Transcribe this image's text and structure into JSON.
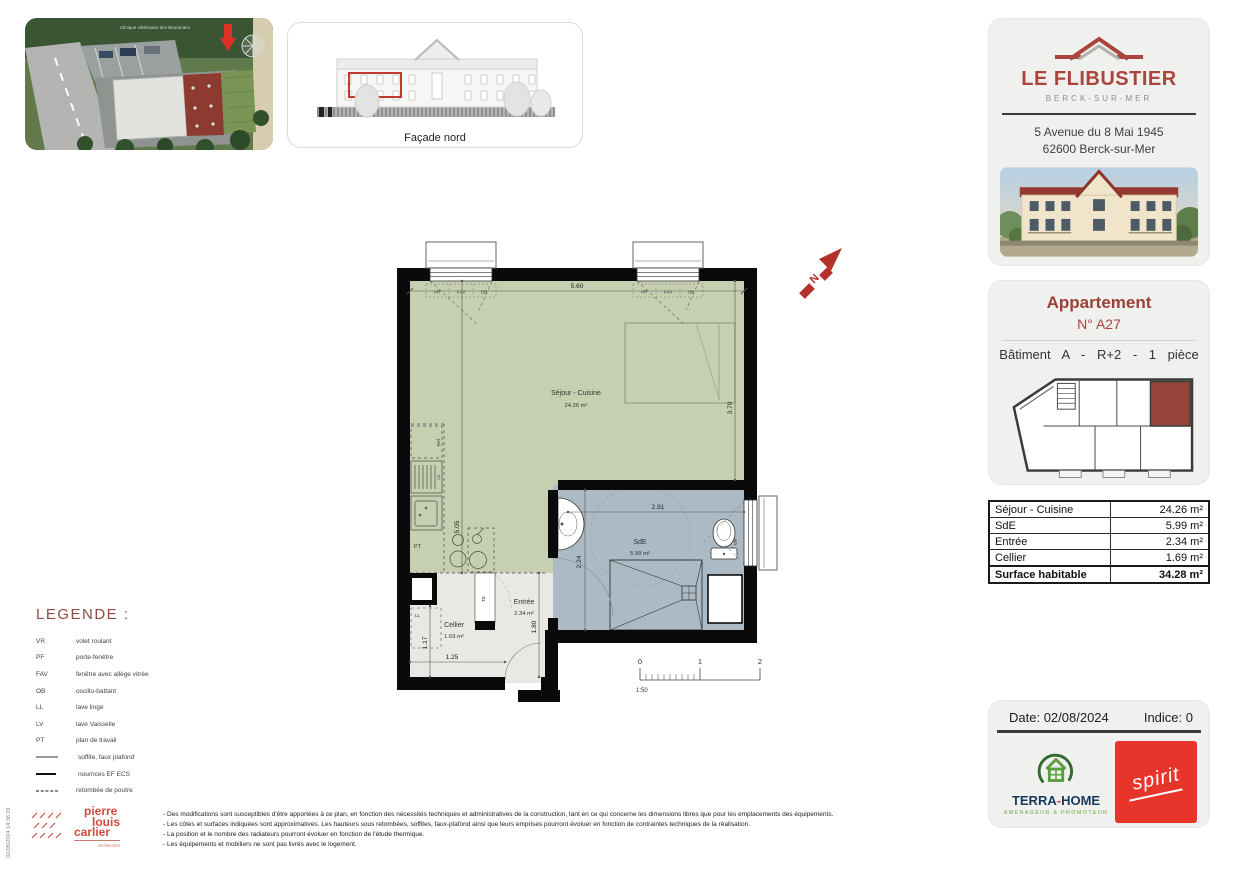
{
  "site_thumb": {
    "caption": "Clinique vétérinaire des Beuraniers"
  },
  "facade_thumb": {
    "caption": "Façade nord"
  },
  "project": {
    "name": "LE FLIBUSTIER",
    "city": "BERCK-SUR-MER",
    "address_line1": "5 Avenue du 8 Mai 1945",
    "address_line2": "62600 Berck-sur-Mer"
  },
  "apartment": {
    "title": "Appartement",
    "number": "N° A27",
    "summary": "Bâtiment A - R+2 - 1 pièce"
  },
  "areas": {
    "rows": [
      {
        "label": "Séjour - Cuisine",
        "value": "24.26 m²"
      },
      {
        "label": "SdE",
        "value": "5.99 m²"
      },
      {
        "label": "Entrée",
        "value": "2.34 m²"
      },
      {
        "label": "Cellier",
        "value": "1.69 m²"
      },
      {
        "label": "Surface habitable",
        "value": "34.28 m²",
        "bold": true
      }
    ]
  },
  "revision": {
    "date_label": "Date:",
    "date": "02/08/2024",
    "indice_label": "Indice:",
    "indice": "0"
  },
  "logos": {
    "terra_home": {
      "name_a": "TERRA",
      "sep": "-",
      "name_b": "HOME",
      "tagline": "AMÉNAGEUR & PROMOTEUR"
    },
    "spirit": {
      "name": "spirit"
    },
    "architect": {
      "line1": "pierre",
      "line2": "louis",
      "line3": "carlier",
      "sub": "architectes"
    }
  },
  "legend": {
    "title": "LEGENDE :",
    "items": [
      {
        "key": "VR",
        "desc": "volet roulant"
      },
      {
        "key": "PF",
        "desc": "porte-fenêtre"
      },
      {
        "key": "FAV",
        "desc": "fenêtre avec allège vitrée"
      },
      {
        "key": "OB",
        "desc": "oscillo-battant"
      },
      {
        "key": "LL",
        "desc": "lave linge"
      },
      {
        "key": "LV",
        "desc": "lave Vaisselle"
      },
      {
        "key": "PT",
        "desc": "plan de travail"
      },
      {
        "type": "hatch",
        "desc": "soffite, faux plafond"
      },
      {
        "type": "grid",
        "desc": "nourrices EF ECS"
      },
      {
        "type": "dash",
        "desc": "retombée de poutre"
      }
    ]
  },
  "plan": {
    "rooms": {
      "sejour": {
        "name": "Séjour - Cuisine",
        "area": "24.26 m²"
      },
      "sde": {
        "name": "SdE",
        "area": "5.99 m²"
      },
      "entree": {
        "name": "Entrée",
        "area": "2.34 m²"
      },
      "cellier": {
        "name": "Cellier",
        "area": "1.69 m²"
      }
    },
    "dims": {
      "top": "5.60",
      "left": "5.05",
      "right": "3.70",
      "sde_w": "2.91",
      "sde_h": "2.24",
      "entree": "1.80",
      "cellier_h": "1.17",
      "cellier_w": "1.25"
    },
    "labels": {
      "vr": "VR",
      "fav": "FAV",
      "ob": "OB",
      "ref": "Ref.",
      "lv": "LV",
      "pt": "PT",
      "ll": "LL",
      "te": "TE"
    },
    "scale": {
      "t0": "0",
      "t1": "1",
      "t2": "2",
      "ratio": "1:50"
    }
  },
  "footer": {
    "disclaimers": [
      "- Des modifications sont susceptibles d'être apportées à ce plan, en fonction des nécessités techniques et administratives de la construction, tant en ce qui concerne les dimensions libres que pour les emplacements des équipements.",
      "- Les côtes et surfaces indiquées sont approximatives. Les hauteurs sous retombées, soffites, faux-plafond ainsi que leurs emprises pourront évoluer en fonction de contraintes techniques de la réalisation.",
      "- La position et le nombre des radiateurs pourront évoluer en fonction de l'étude thermique.",
      "- Les équipements et mobiliers ne sont pas livrés avec le logement."
    ],
    "timestamp": "02/08/2024 14:38:29"
  },
  "colors": {
    "brand_red": "#a9453c",
    "plan_green": "#c7cfb1",
    "plan_blue": "#abbac4",
    "spirit_red": "#e8352c"
  }
}
